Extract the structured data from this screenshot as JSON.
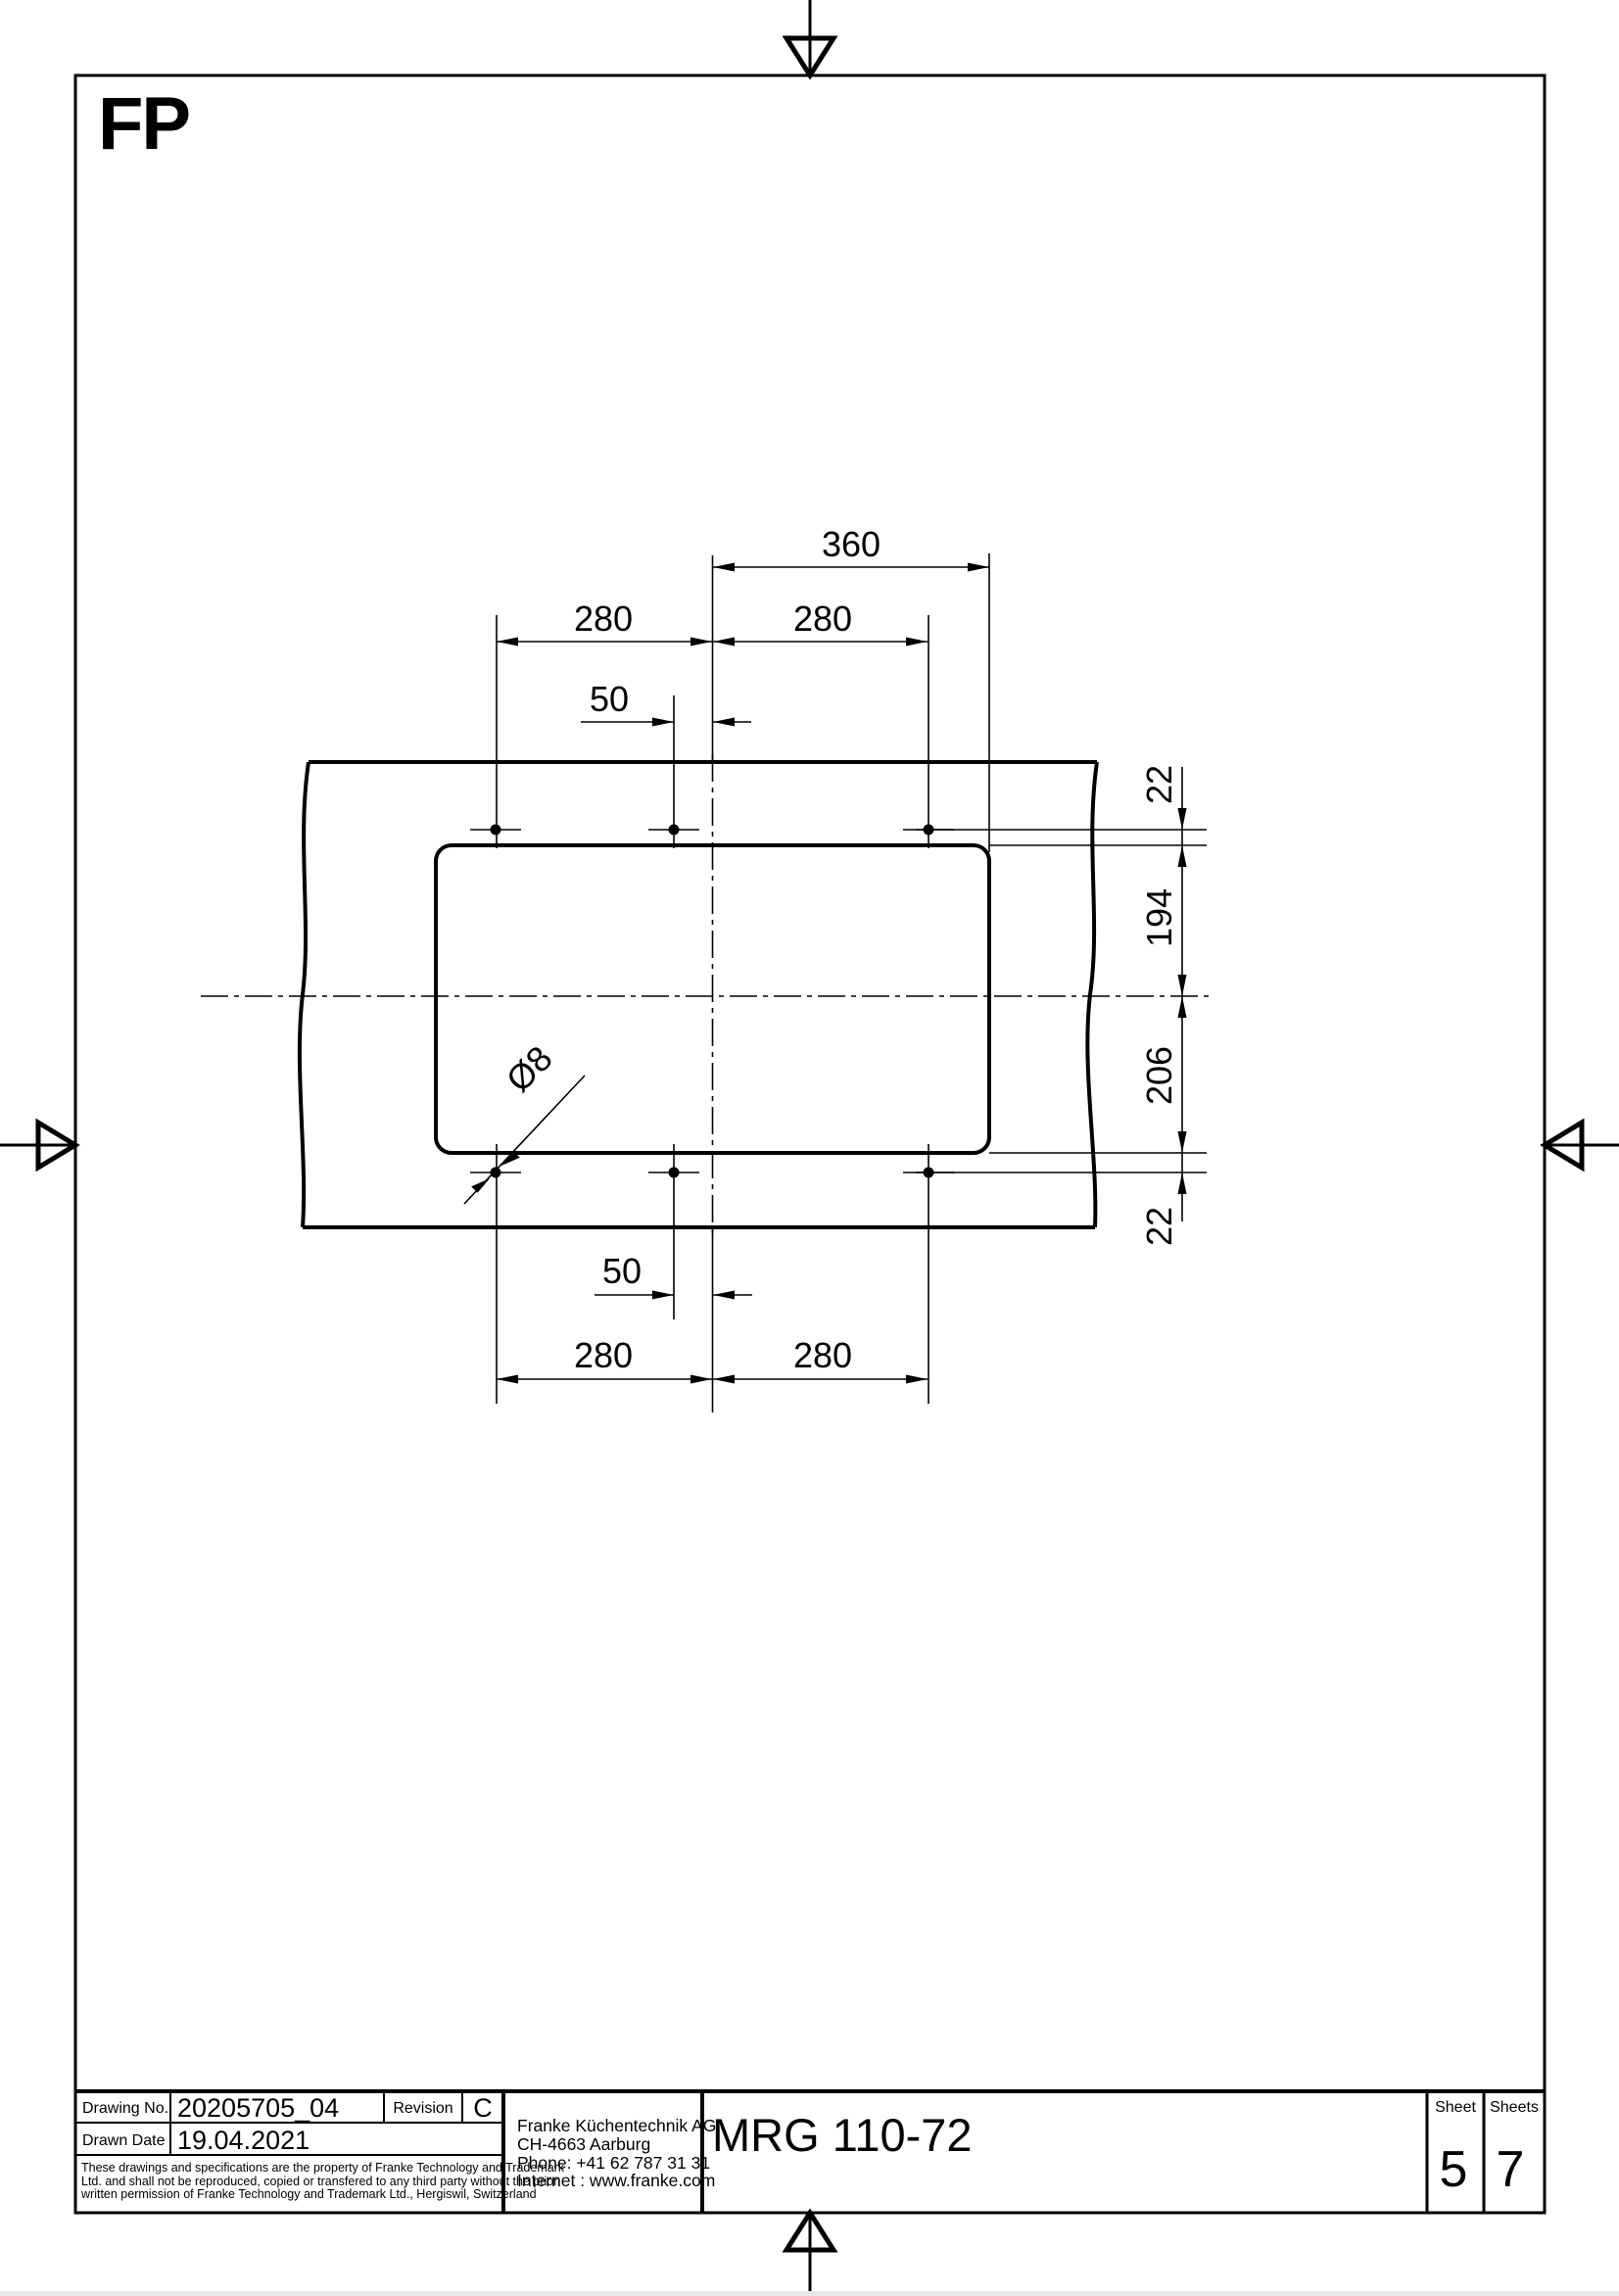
{
  "page": {
    "fp_label": "FP"
  },
  "drawing": {
    "dims": {
      "top_width": "360",
      "top_left_span": "280",
      "top_right_span": "280",
      "top_offset": "50",
      "bottom_offset": "50",
      "bottom_left_span": "280",
      "bottom_right_span": "280",
      "edge_top": "22",
      "upper_height": "194",
      "lower_height": "206",
      "edge_bottom": "22",
      "hole_diameter": "Ø8"
    }
  },
  "title_block": {
    "drawing_no_label": "Drawing No.",
    "drawing_no_value": "20205705_04",
    "revision_label": "Revision",
    "revision_value": "C",
    "drawn_date_label": "Drawn Date",
    "drawn_date_value": "19.04.2021",
    "disclaimer_line1": "These drawings and specifications are the property of Franke Technology and Trademark",
    "disclaimer_line2": "Ltd. and shall not be reproduced, copied or transfered to any third party without the prior",
    "disclaimer_line3": "written permission of Franke Technology and Trademark Ltd., Hergiswil, Switzerland",
    "company": {
      "name": "Franke Küchentechnik AG",
      "address": "CH-4663 Aarburg",
      "phone": "Phone:  +41 62 787 31 31",
      "internet": "Internet :  www.franke.com"
    },
    "product_title": "MRG 110-72",
    "sheet_label": "Sheet",
    "sheet_value": "5",
    "sheets_label": "Sheets",
    "sheets_value": "7"
  }
}
